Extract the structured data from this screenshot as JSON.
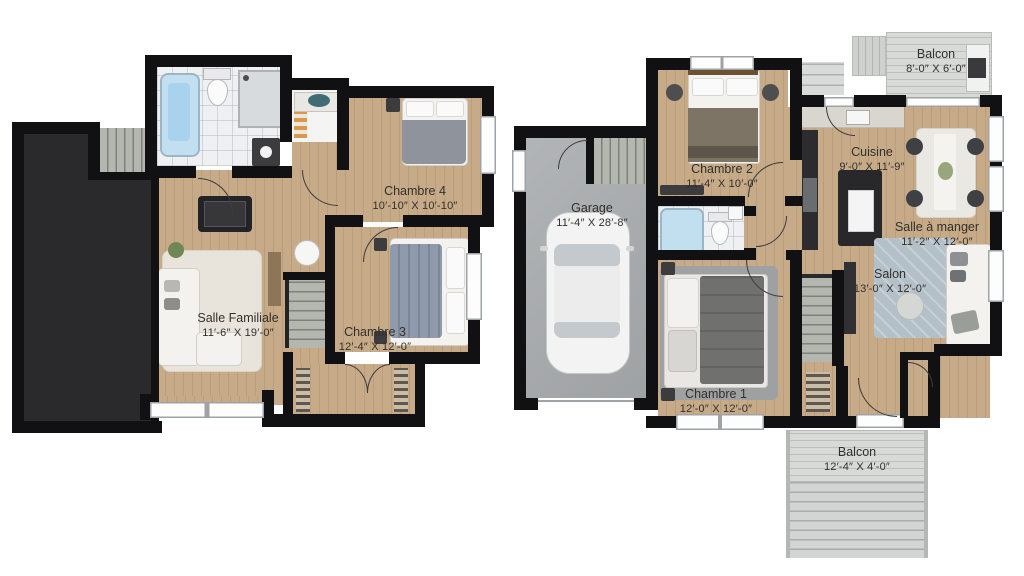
{
  "basement": {
    "chambre4": {
      "label": "Chambre 4",
      "dims": "10′-10″ X 10′-10″"
    },
    "salle_familiale": {
      "label": "Salle Familiale",
      "dims": "11′-6″ X 19′-0″"
    },
    "chambre3": {
      "label": "Chambre 3",
      "dims": "12′-4″ X 12′-0″"
    }
  },
  "main_floor": {
    "garage": {
      "label": "Garage",
      "dims": "11′-4″ X 28′-8″"
    },
    "chambre2": {
      "label": "Chambre 2",
      "dims": "11′-4″ X 10′-0″"
    },
    "cuisine": {
      "label": "Cuisine",
      "dims": "9′-0″ X 11′-9″"
    },
    "salle_a_manger": {
      "label": "Salle à manger",
      "dims": "11′-2″ X 12′-0″"
    },
    "salon": {
      "label": "Salon",
      "dims": "13′-0″ X 12′-0″"
    },
    "chambre1": {
      "label": "Chambre 1",
      "dims": "12′-0″ X 12′-0″"
    },
    "balcon_haut": {
      "label": "Balcon",
      "dims": "8′-0″ X 6′-0″"
    },
    "balcon_bas": {
      "label": "Balcon",
      "dims": "12′-4″ X 4′-0″"
    }
  },
  "colors": {
    "wall": "#111113",
    "wood_floor": "#c7aa88",
    "tile_floor": "#eef0f1",
    "garage_floor": "#a9acae",
    "unfinished_area": "#2a2a2d",
    "deck": "#d8dad7",
    "tub_accent": "#aed4ec",
    "label_text": "#33302c"
  }
}
